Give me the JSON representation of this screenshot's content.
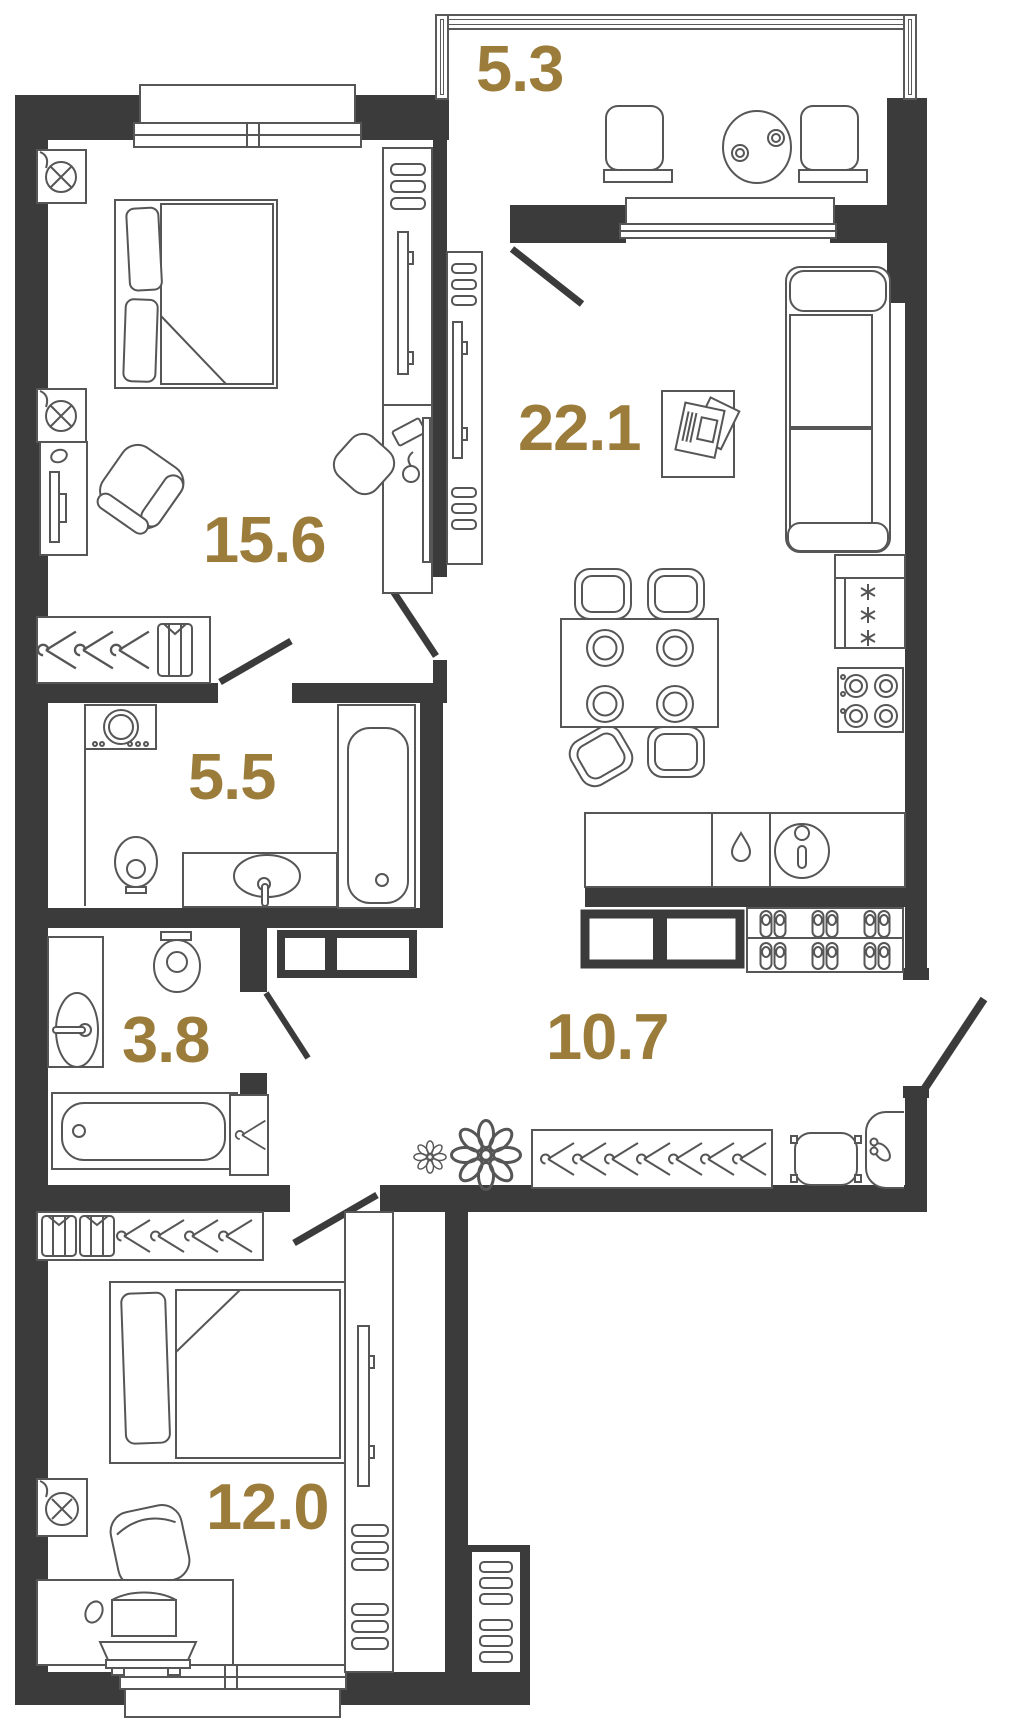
{
  "plan": {
    "type": "apartment-floor-plan",
    "wall_color": "#3b3b3c",
    "furniture_line_color": "#565656",
    "label_color": "#9b7c3b",
    "rooms": [
      {
        "id": "balcony",
        "area": "5.3",
        "furniture": [
          "stool-icon",
          "round-table-icon",
          "cups-icon",
          "stool-icon"
        ]
      },
      {
        "id": "living-kitchen",
        "area": "22.1",
        "furniture": [
          "sofa-icon",
          "coffee-table-icon",
          "magazine-icon",
          "dining-table-icon",
          "plate-icon",
          "chair-icon",
          "fridge-icon",
          "stove-icon",
          "kitchen-counter-icon",
          "dishwasher-icon",
          "sink-icon",
          "tv-icon",
          "shelves-icon",
          "window-icon",
          "balcony-door-icon"
        ]
      },
      {
        "id": "bedroom-master",
        "area": "15.6",
        "furniture": [
          "double-bed-icon",
          "pillow-icon",
          "ceiling-lamp-icon",
          "tv-stand-icon",
          "armchair-icon",
          "wardrobe-hangers-icon",
          "shirt-icon",
          "desk-icon",
          "keyboard-icon",
          "mouse-icon",
          "desk-chair-icon",
          "shelves-icon",
          "window-icon",
          "door-icon"
        ]
      },
      {
        "id": "bathroom",
        "area": "5.5",
        "furniture": [
          "washing-machine-icon",
          "toilet-icon",
          "washbasin-icon",
          "bathtub-icon",
          "door-icon"
        ]
      },
      {
        "id": "bathroom-guest",
        "area": "3.8",
        "furniture": [
          "washbasin-icon",
          "toilet-icon",
          "bathtub-icon",
          "door-icon"
        ]
      },
      {
        "id": "hallway",
        "area": "10.7",
        "furniture": [
          "shoe-bench-icon",
          "slippers-shelf-icon",
          "coat-rack-icon",
          "hanger-icon",
          "flower-icon",
          "pouf-icon",
          "shoe-horn-icon",
          "entrance-door-icon"
        ]
      },
      {
        "id": "bedroom-second",
        "area": "12.0",
        "furniture": [
          "single-bed-icon",
          "pillow-icon",
          "wardrobe-hangers-icon",
          "shirt-icon",
          "ceiling-lamp-icon",
          "armchair-icon",
          "desk-icon",
          "laptop-icon",
          "mouse-icon",
          "keyboard-tray-icon",
          "tv-icon",
          "shelves-icon",
          "vent-duct-icon",
          "window-icon",
          "door-icon"
        ]
      }
    ]
  }
}
